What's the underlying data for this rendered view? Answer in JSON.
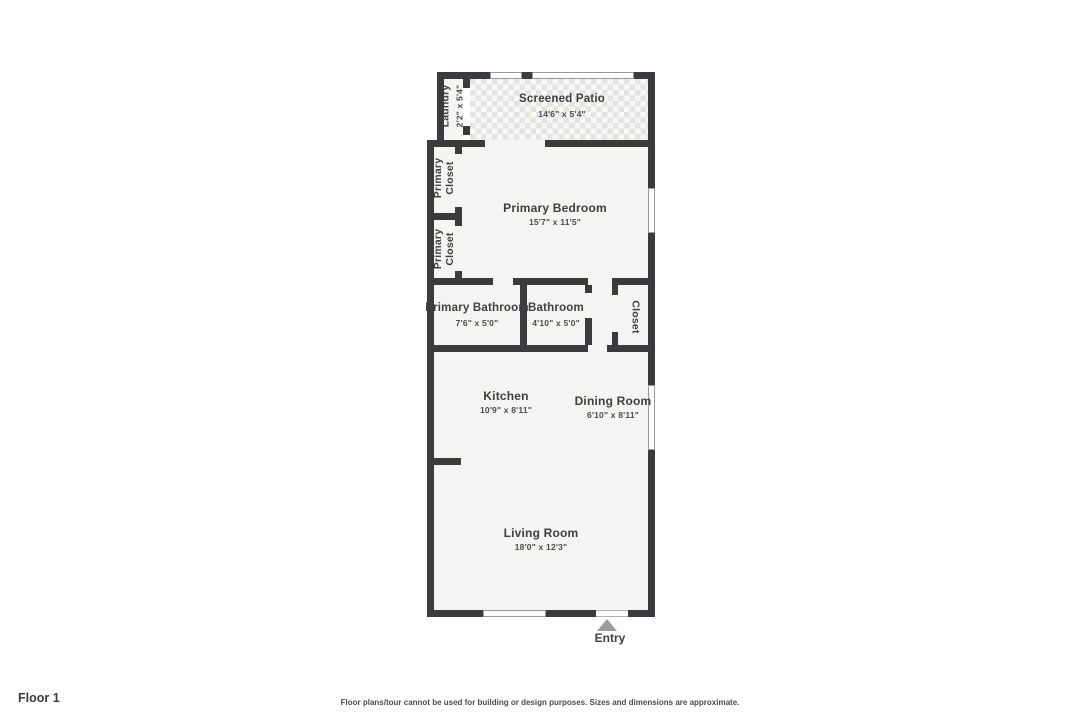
{
  "floor_plan": {
    "rooms": [
      {
        "name": "Laundry",
        "dims": "2'2\" x 5'4\""
      },
      {
        "name": "Screened Patio",
        "dims": "14'6\" x 5'4\""
      },
      {
        "name": "Primary Closet",
        "dims": ""
      },
      {
        "name": "Primary Closet",
        "dims": ""
      },
      {
        "name": "Primary Bedroom",
        "dims": "15'7\" x 11'5\""
      },
      {
        "name": "Primary Bathroom",
        "dims": "7'6\" x 5'0\""
      },
      {
        "name": "Bathroom",
        "dims": "4'10\" x 5'0\""
      },
      {
        "name": "Closet",
        "dims": ""
      },
      {
        "name": "Kitchen",
        "dims": "10'9\" x 8'11\""
      },
      {
        "name": "Dining Room",
        "dims": "6'10\" x 8'11\""
      },
      {
        "name": "Living Room",
        "dims": "18'0\" x 12'3\""
      }
    ],
    "entry_label": "Entry",
    "floor_label": "Floor 1",
    "disclaimer": "Floor plans/tour cannot be used for building or design purposes. Sizes and dimensions are approximate.",
    "colors": {
      "wall": "#3b3b3e",
      "room_fill": "#f4f4f2",
      "patio_tile_light": "#f7f7f5",
      "patio_tile_dark": "#e4e4e1",
      "entry_arrow": "#9c9c9c",
      "label_text": "#3e3e44"
    }
  }
}
